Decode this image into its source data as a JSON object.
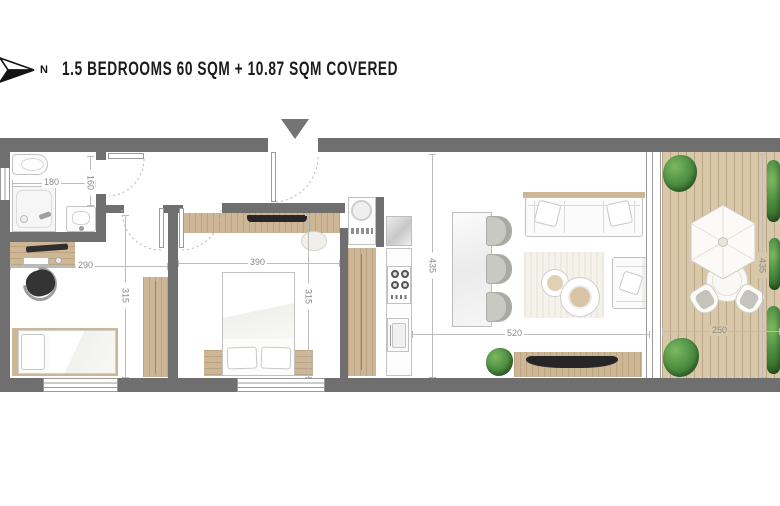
{
  "header": {
    "north_label": "N",
    "title": "1.5 BEDROOMS 60 SQM + 10.87 SQM COVERED"
  },
  "dimensions": {
    "bathroom_width": "180",
    "bathroom_depth": "160",
    "office_width": "290",
    "office_depth": "315",
    "bedroom_width": "390",
    "bedroom_depth": "315",
    "living_depth": "435",
    "living_width": "520",
    "terrace_depth": "435",
    "terrace_width": "250"
  },
  "icons": {
    "north_arrow": "compass-arrow-pointing-right",
    "entrance_marker": "downward-triangle",
    "umbrella": "hexagonal-parasol",
    "plant": "green-shrub"
  },
  "colors": {
    "wall": "#6f6f6f",
    "wood": "#cdb695",
    "deck": "#d9c7aa",
    "plant_green": "#4e8c3f",
    "title_text": "#1b1b1b",
    "dimension_text": "#8a8a8a"
  }
}
